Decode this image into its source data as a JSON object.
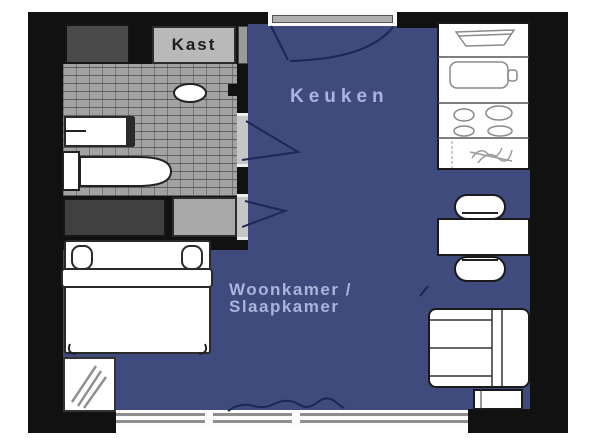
{
  "floorplan": {
    "labels": {
      "closet": "Kast",
      "kitchen": "Keuken",
      "living_line1": "Woonkamer /",
      "living_line2": "Slaapkamer"
    },
    "rooms": [
      "Keuken",
      "Woonkamer / Slaapkamer",
      "Kast"
    ],
    "colors": {
      "floor": "#3f4a7d",
      "label_text": "#aab4dc",
      "wall": "#111111",
      "tile_floor": "#a2a2a2",
      "closet_dark": "#4a4a4a",
      "cabinet_light": "#b9b9b9",
      "window_line": "#8e8e8e",
      "door_line": "#1c2757",
      "furniture_outline": "#222222",
      "furniture_fill": "#ffffff"
    }
  }
}
